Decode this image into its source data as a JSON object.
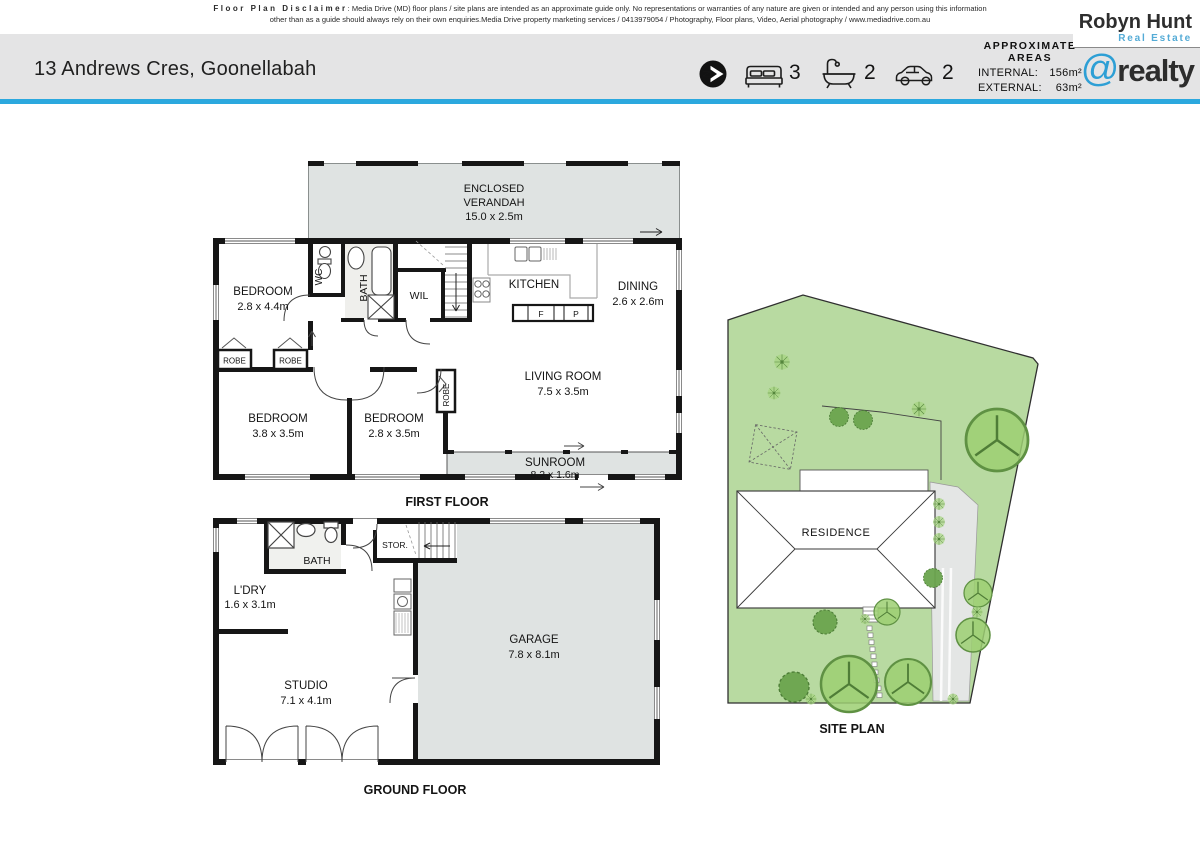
{
  "disclaimer": {
    "title": "Floor Plan Disclaimer",
    "line1": ": Media Drive (MD) floor plans / site plans are intended as an approximate guide only.  No representations or warranties of any nature are given or intended and any person using this information",
    "line2": "other than as a guide should always rely on their own enquiries.Media Drive property marketing services / 0413979054 / Photography, Floor plans,  Video, Aerial photography / www.mediadrive.com.au"
  },
  "header": {
    "address": "13 Andrews Cres, Goonellabah",
    "beds": "3",
    "baths": "2",
    "cars": "2",
    "areas": {
      "title1": "APPROXIMATE",
      "title2": "AREAS",
      "internal_label": "INTERNAL:",
      "internal_value": "156m²",
      "external_label": "EXTERNAL:",
      "external_value": "63m²"
    },
    "agency": {
      "name": "Robyn Hunt",
      "tagline": "Real Estate",
      "brand_at": "@",
      "brand": "realty"
    }
  },
  "icons": {
    "north": "north-compass",
    "beds": "bed",
    "baths": "bathtub",
    "cars": "car"
  },
  "colors": {
    "accent": "#2BA8DE",
    "plan_fill": "#DFE3E2",
    "site_green": "#B8DAA1",
    "wall": "#161616",
    "brand_blue": "#2D9FD5"
  },
  "first_floor": {
    "caption": "FIRST FLOOR",
    "verandah_1": "ENCLOSED",
    "verandah_2": "VERANDAH",
    "verandah_d": "15.0 x 2.5m",
    "bed1": "BEDROOM",
    "bed1_d": "2.8 x 4.4m",
    "wc": "WC",
    "bath": "BATH",
    "wil": "WIL",
    "kitchen": "KITCHEN",
    "fridge": "F",
    "pantry": "P",
    "dining": "DINING",
    "dining_d": "2.6 x 2.6m",
    "living": "LIVING ROOM",
    "living_d": "7.5 x 3.5m",
    "bed2": "BEDROOM",
    "bed2_d": "3.8 x 3.5m",
    "bed3": "BEDROOM",
    "bed3_d": "2.8 x 3.5m",
    "sunroom": "SUNROOM",
    "sunroom_d": "8.2 x 1.6m",
    "robe": "ROBE"
  },
  "ground_floor": {
    "caption": "GROUND FLOOR",
    "bath": "BATH",
    "stor": "STOR.",
    "ldry": "L'DRY",
    "ldry_d": "1.6 x 3.1m",
    "garage": "GARAGE",
    "garage_d": "7.8 x 8.1m",
    "studio": "STUDIO",
    "studio_d": "7.1 x 4.1m"
  },
  "site_plan": {
    "caption": "SITE PLAN",
    "residence": "RESIDENCE"
  }
}
